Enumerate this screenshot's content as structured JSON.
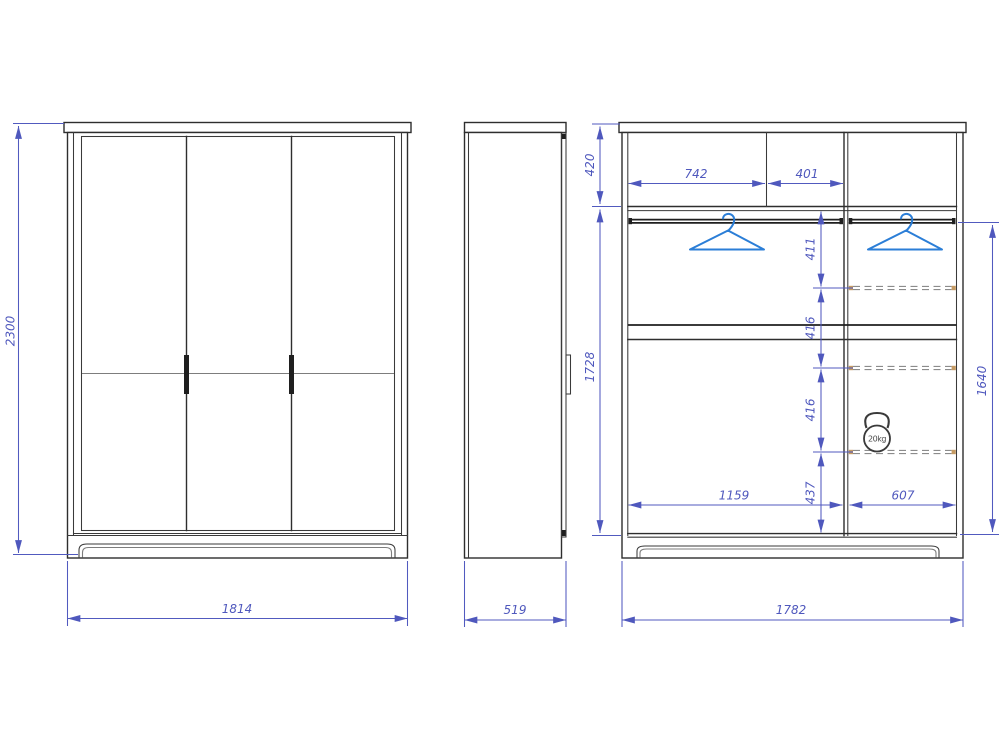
{
  "drawing": {
    "front_view": {
      "height_mm": "2300",
      "width_mm": "1814"
    },
    "side_view": {
      "depth_mm": "519"
    },
    "interior_view": {
      "top_section_height_mm": "420",
      "interior_height_mm": "1728",
      "interior_width_mm": "1782",
      "upper_compartment_widths_mm": [
        "742",
        "401"
      ],
      "shelf_spacing_mm": [
        "411",
        "416",
        "416",
        "437"
      ],
      "compartment_widths_mm": [
        "1159",
        "607"
      ],
      "right_section_height_mm": "1640",
      "shelf_max_load": "20kg"
    },
    "icons": {
      "hanger_icon": "clothes-hanger",
      "load_icon": "kettlebell-weight"
    },
    "colors": {
      "dimension_blue": "#515abf",
      "hanger_blue": "#2b7ed7",
      "outline_dark": "#2e2e2e",
      "shelf_pin_tan": "#c59b63"
    }
  }
}
